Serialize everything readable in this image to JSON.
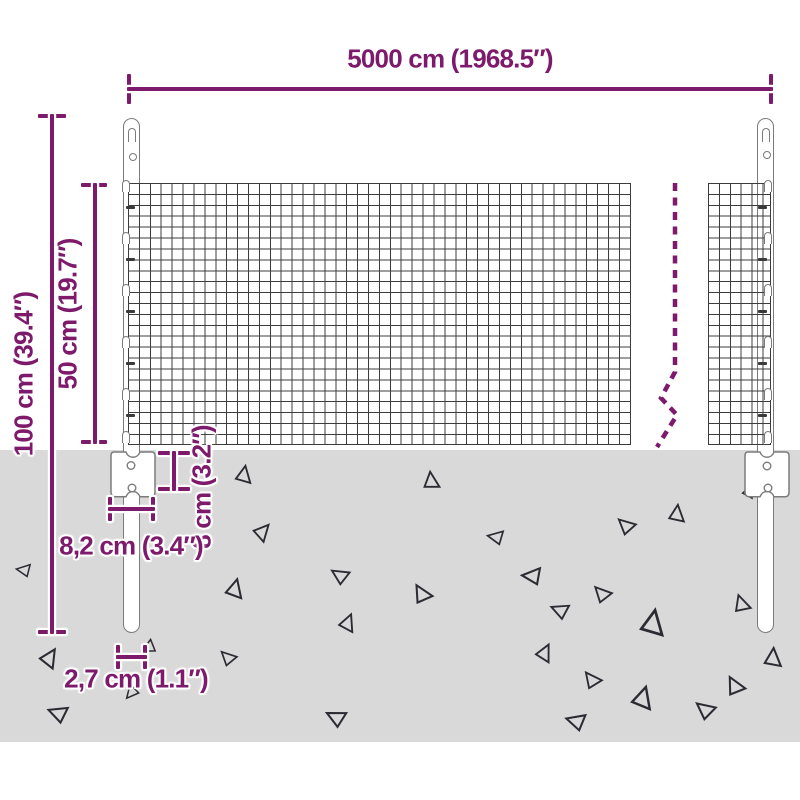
{
  "labels": {
    "width": "5000 cm (1968.5″)",
    "height_total": "100 cm (39.4″)",
    "height_mesh": "50 cm (19.7″)",
    "anchor_depth": "8 cm (3.2″)",
    "anchor_width": "8,2 cm (3.4″)",
    "post_diameter": "2,7 cm (1.1″)"
  },
  "colors": {
    "dimension": "#7E1A6C",
    "ground": "#D9D9D9",
    "mesh": "#3C3C3C",
    "outline": "#7B7B7B",
    "triangle": "#2B2B33"
  },
  "ground": {
    "triangles": [
      {
        "x": 244,
        "y": 474,
        "s": 11,
        "r": 10
      },
      {
        "x": 431,
        "y": 480,
        "s": 11,
        "r": -6
      },
      {
        "x": 263,
        "y": 531,
        "s": 11,
        "r": 42
      },
      {
        "x": 495,
        "y": 537,
        "s": 10,
        "r": -80
      },
      {
        "x": 235,
        "y": 588,
        "s": 12,
        "r": 14
      },
      {
        "x": 339,
        "y": 575,
        "s": 11,
        "r": -58
      },
      {
        "x": 348,
        "y": 622,
        "s": 11,
        "r": 22
      },
      {
        "x": 421,
        "y": 593,
        "s": 12,
        "r": -30
      },
      {
        "x": 625,
        "y": 525,
        "s": 11,
        "r": -48
      },
      {
        "x": 677,
        "y": 513,
        "s": 11,
        "r": 6
      },
      {
        "x": 531,
        "y": 576,
        "s": 12,
        "r": -86
      },
      {
        "x": 601,
        "y": 593,
        "s": 11,
        "r": -44
      },
      {
        "x": 559,
        "y": 610,
        "s": 11,
        "r": -68
      },
      {
        "x": 653,
        "y": 622,
        "s": 16,
        "r": 10
      },
      {
        "x": 741,
        "y": 603,
        "s": 11,
        "r": -18
      },
      {
        "x": 773,
        "y": 657,
        "s": 12,
        "r": 4
      },
      {
        "x": 545,
        "y": 652,
        "s": 11,
        "r": 26
      },
      {
        "x": 591,
        "y": 679,
        "s": 11,
        "r": -38
      },
      {
        "x": 643,
        "y": 697,
        "s": 14,
        "r": 16
      },
      {
        "x": 704,
        "y": 709,
        "s": 12,
        "r": -52
      },
      {
        "x": 734,
        "y": 685,
        "s": 12,
        "r": -28
      },
      {
        "x": 575,
        "y": 721,
        "s": 12,
        "r": -74
      },
      {
        "x": 335,
        "y": 717,
        "s": 12,
        "r": -64
      },
      {
        "x": 57,
        "y": 713,
        "s": 12,
        "r": -70
      },
      {
        "x": 50,
        "y": 657,
        "s": 12,
        "r": 32
      },
      {
        "x": 23,
        "y": 570,
        "s": 9,
        "r": -82
      },
      {
        "x": 227,
        "y": 657,
        "s": 10,
        "r": -46
      },
      {
        "x": 148,
        "y": 648,
        "s": 9,
        "r": -118
      },
      {
        "x": 131,
        "y": 693,
        "s": 9,
        "r": -140
      },
      {
        "x": 749,
        "y": 491,
        "s": 8,
        "r": 22
      }
    ]
  }
}
